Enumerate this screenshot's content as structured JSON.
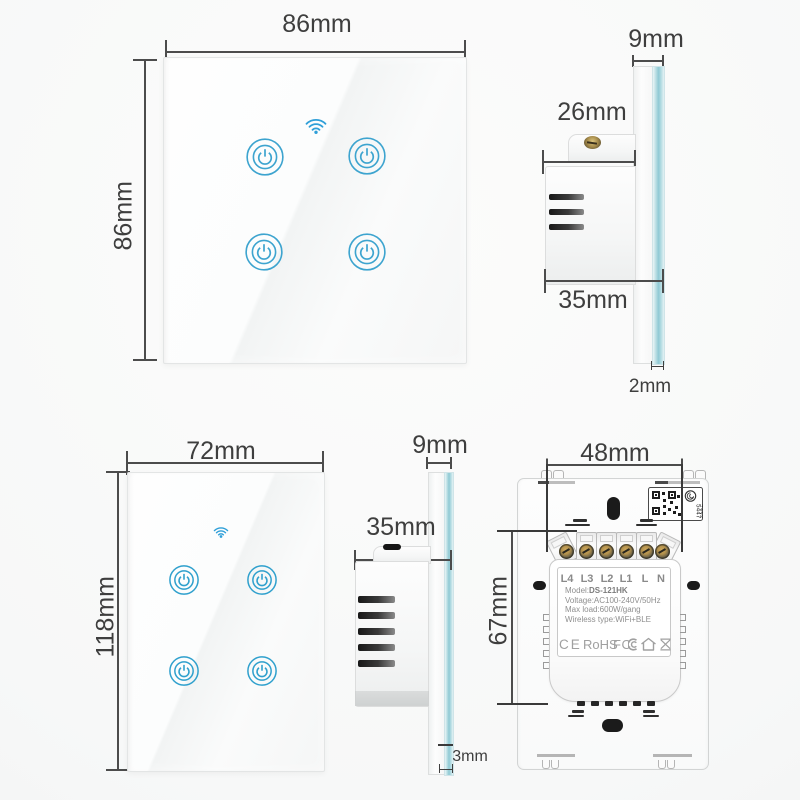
{
  "colors": {
    "accent_blue": "#3da4cf",
    "wifi_blue": "#2f9fd8",
    "glass_edge_cyan": "#8ec9d4",
    "dimension_line": "#4c4c4c"
  },
  "eu_front": {
    "width_label": "86mm",
    "height_label": "86mm"
  },
  "eu_side": {
    "total_width_label": "9mm",
    "box_depth_label": "26mm",
    "full_depth_label": "35mm",
    "glass_thickness_label": "2mm"
  },
  "us_front": {
    "width_label": "72mm",
    "height_label": "118mm"
  },
  "us_side": {
    "total_width_label": "9mm",
    "depth_label": "35mm",
    "glass_thickness_label": "3mm"
  },
  "back_view": {
    "terminal_span_label": "48mm",
    "body_height_label": "67mm",
    "terminals": [
      "L4",
      "L3",
      "L2",
      "L1",
      "L",
      "N"
    ],
    "spec_model_key": "Model:",
    "spec_model_value": "DS-121HK",
    "spec_voltage": "Voltage:AC100-240V/50Hz",
    "spec_max_load": "Max load:600W/gang",
    "spec_wireless": "Wireless type:WiFi+BLE",
    "cert_ce": "CE",
    "cert_rohs": "RoHS",
    "cert_fcc": "FC",
    "qr_serial_top": "5447",
    "qr_serial_bottom": "4125"
  }
}
